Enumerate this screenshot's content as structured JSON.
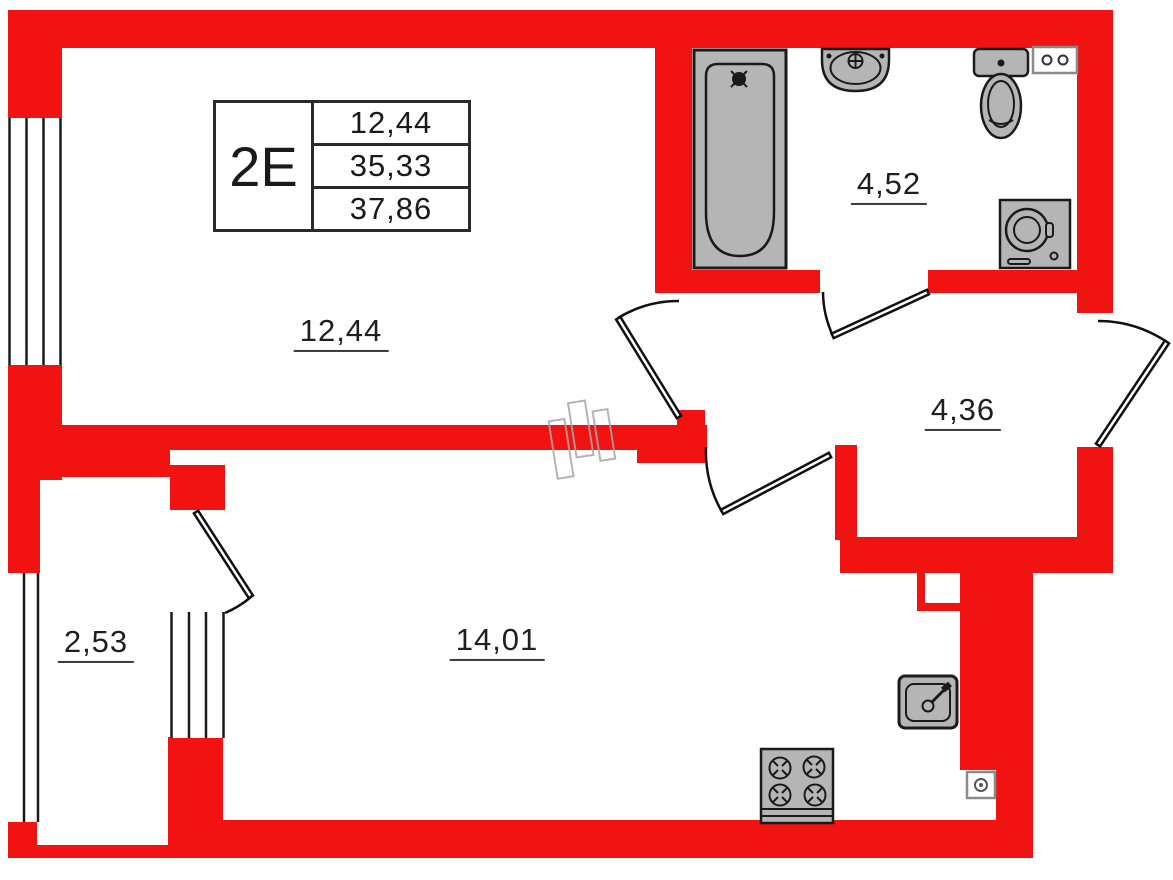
{
  "colors": {
    "wall_red": "#f01312",
    "fixture_gray": "#b5b5b5",
    "line": "#1a1a1a",
    "ghost_gray": "#a8a8a8"
  },
  "unit_card": {
    "unit": "2E",
    "values": [
      "12,44",
      "35,33",
      "37,86"
    ]
  },
  "rooms": {
    "living": {
      "label": "12,44"
    },
    "bathroom": {
      "label": "4,52"
    },
    "hall": {
      "label": "4,36"
    },
    "balcony": {
      "label": "2,53"
    },
    "kitchen_living": {
      "label": "14,01"
    }
  },
  "fixtures": [
    "bathtub",
    "washbasin",
    "toilet",
    "wall-outlet-box",
    "washing-machine",
    "kitchen-sink",
    "stove",
    "vent-box"
  ]
}
